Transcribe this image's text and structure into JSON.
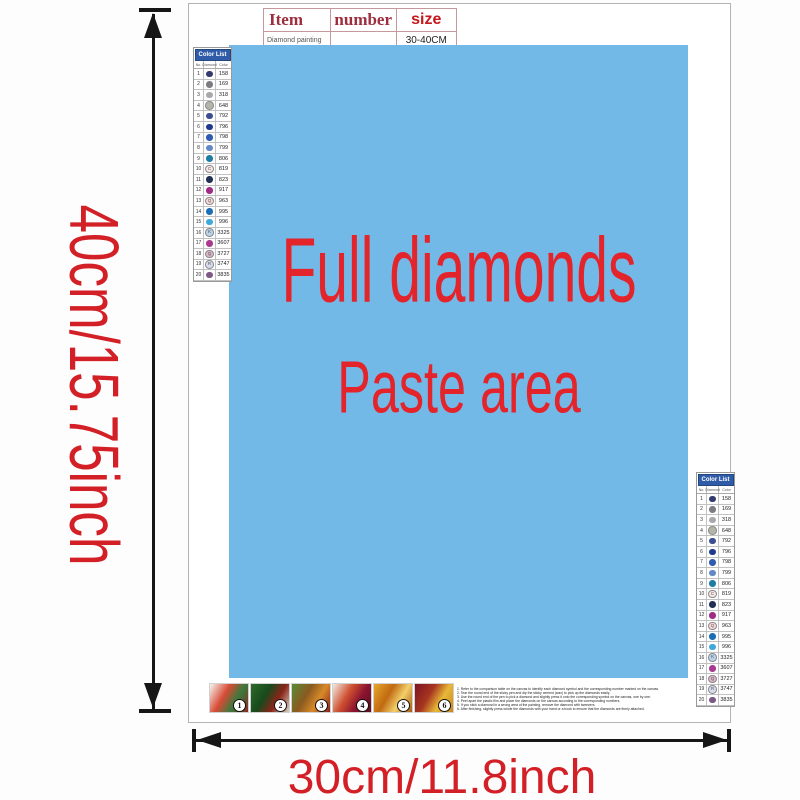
{
  "dimensions": {
    "height_label": "40cm/15.75inch",
    "width_label": "30cm/11.8inch"
  },
  "top_table": {
    "headers": {
      "item": "Item",
      "number": "number",
      "size": "size"
    },
    "row": {
      "item": "Diamond painting",
      "number": "",
      "size": "30-40CM"
    }
  },
  "paste_area": {
    "line1": "Full diamonds",
    "line2": "Paste area",
    "bg_color": "#73b9e8",
    "text_color": "#e3242a"
  },
  "color_list": {
    "title": "Color List",
    "columns": [
      "No.",
      "Diamond",
      "Color"
    ],
    "rows": [
      {
        "no": "1",
        "symbol": "",
        "code": "158",
        "color": "#333a6e",
        "light": false
      },
      {
        "no": "2",
        "symbol": "",
        "code": "169",
        "color": "#7b7d80",
        "light": false
      },
      {
        "no": "3",
        "symbol": "",
        "code": "318",
        "color": "#a7a9ac",
        "light": false
      },
      {
        "no": "4",
        "symbol": "",
        "code": "648",
        "color": "#b4b5a9",
        "light": true
      },
      {
        "no": "5",
        "symbol": "",
        "code": "792",
        "color": "#3c4d92",
        "light": false
      },
      {
        "no": "6",
        "symbol": "",
        "code": "796",
        "color": "#203a8f",
        "light": false
      },
      {
        "no": "7",
        "symbol": "",
        "code": "798",
        "color": "#2f5cb1",
        "light": false
      },
      {
        "no": "8",
        "symbol": "",
        "code": "799",
        "color": "#6487c8",
        "light": false
      },
      {
        "no": "9",
        "symbol": "",
        "code": "806",
        "color": "#1e7ca6",
        "light": false
      },
      {
        "no": "10",
        "symbol": "C",
        "code": "819",
        "color": "#f7e6e6",
        "light": true
      },
      {
        "no": "11",
        "symbol": "",
        "code": "823",
        "color": "#222f55",
        "light": false
      },
      {
        "no": "12",
        "symbol": "",
        "code": "917",
        "color": "#a02b86",
        "light": false
      },
      {
        "no": "13",
        "symbol": "Q",
        "code": "963",
        "color": "#f9d8da",
        "light": true
      },
      {
        "no": "14",
        "symbol": "",
        "code": "995",
        "color": "#1d6fb5",
        "light": false
      },
      {
        "no": "15",
        "symbol": "",
        "code": "996",
        "color": "#3fa8dd",
        "light": false
      },
      {
        "no": "16",
        "symbol": "K",
        "code": "3325",
        "color": "#b7d2ea",
        "light": true
      },
      {
        "no": "17",
        "symbol": "",
        "code": "3607",
        "color": "#a93a90",
        "light": false
      },
      {
        "no": "18",
        "symbol": "Q",
        "code": "3727",
        "color": "#dcb4c8",
        "light": true
      },
      {
        "no": "19",
        "symbol": "R",
        "code": "3747",
        "color": "#d8dbee",
        "light": true
      },
      {
        "no": "20",
        "symbol": "",
        "code": "3835",
        "color": "#7d5a86",
        "light": false
      }
    ]
  },
  "steps": [
    {
      "num": "1",
      "palette": [
        "#f5f7f2",
        "#d84b35",
        "#3a7a3c",
        "#8c2b24"
      ]
    },
    {
      "num": "2",
      "palette": [
        "#2e6b2a",
        "#174a1c",
        "#8a2418",
        "#d8d2c0"
      ]
    },
    {
      "num": "3",
      "palette": [
        "#5a8a34",
        "#8a5a20",
        "#d88a28",
        "#8a1f1f"
      ]
    },
    {
      "num": "4",
      "palette": [
        "#f2ece2",
        "#cf5030",
        "#8c1430",
        "#5a0f20"
      ]
    },
    {
      "num": "5",
      "palette": [
        "#e8a72a",
        "#c06a12",
        "#f3cf6a",
        "#a85a10"
      ]
    },
    {
      "num": "6",
      "palette": [
        "#7c1322",
        "#a7351f",
        "#e8b838",
        "#c8861c"
      ]
    }
  ],
  "instructions": [
    "1. Refer to the comparison table on the canvas to identify each diamond symbol and the corresponding number marked on the canvas.",
    "2. Tear the round end of the sticky pen and dip the sticky cement (wax) to pick up the diamonds easily.",
    "3. Use the round end of the pen to pick a diamond and slightly press it onto the corresponding symbol on the canvas, one by one.",
    "4. Peel apart the plastic film and place the diamonds on the canvas according to the corresponding numbers.",
    "5. If you stick a diamond in a wrong area of the painting, remove the diamond with tweezers.",
    "6. After finishing, slightly press whole the diamonds with your hand or a book to ensure that the diamonds are firmly attached."
  ]
}
